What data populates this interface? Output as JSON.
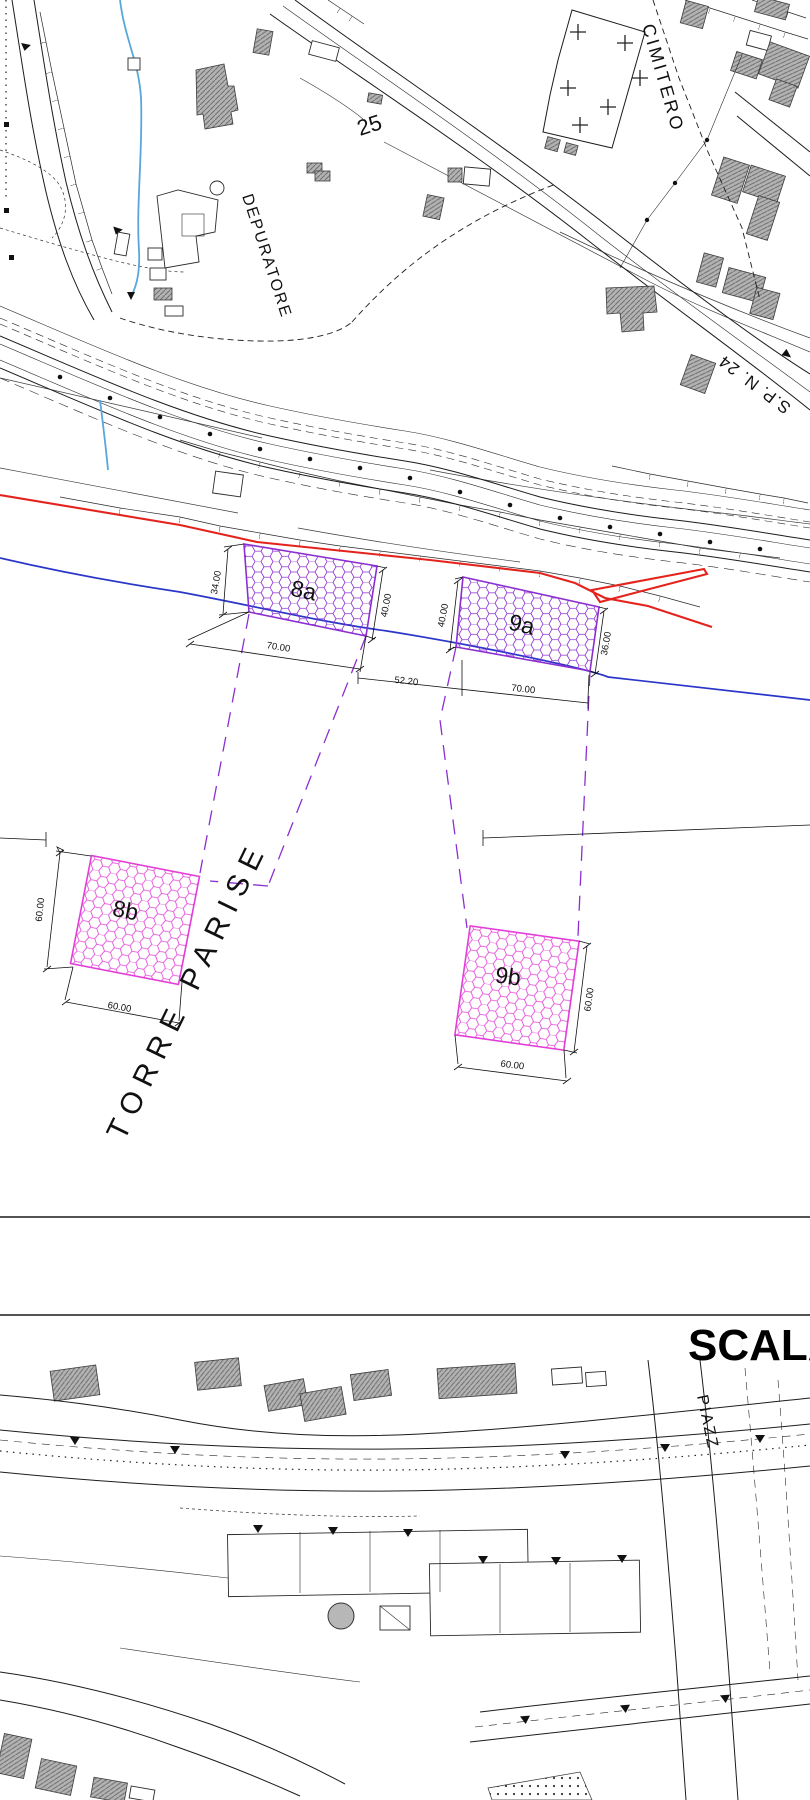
{
  "colors": {
    "violet": "#8B2FD0",
    "magenta": "#E23FD8",
    "red": "#E4231C",
    "blue": "#2A36C8",
    "stream": "#58A7DB"
  },
  "upper_map": {
    "labels": {
      "contour": "25",
      "depuratore": "DEPURATORE",
      "cimitero": "CIMITERO",
      "road": "S.P. N. 24",
      "site": "TORRE PARISE"
    },
    "zones": [
      {
        "id": "8a",
        "label": "8a",
        "dim_left": "34.00",
        "dim_right": "40.00",
        "dim_bottom": "70.00"
      },
      {
        "id": "9a",
        "label": "9a",
        "dim_left": "40.00",
        "dim_right": "36.00",
        "dim_bottom": "70.00"
      },
      {
        "id": "8b",
        "label": "8b",
        "dim_left": "60.00",
        "dim_bottom": "60.00"
      },
      {
        "id": "9b",
        "label": "9b",
        "dim_right": "60.00",
        "dim_bottom": "60.00"
      }
    ],
    "gap_dim": "52.20"
  },
  "scale_section": {
    "title": "SCALA"
  },
  "lower_map": {
    "labels": {
      "piazza": "PIAZZ"
    }
  }
}
